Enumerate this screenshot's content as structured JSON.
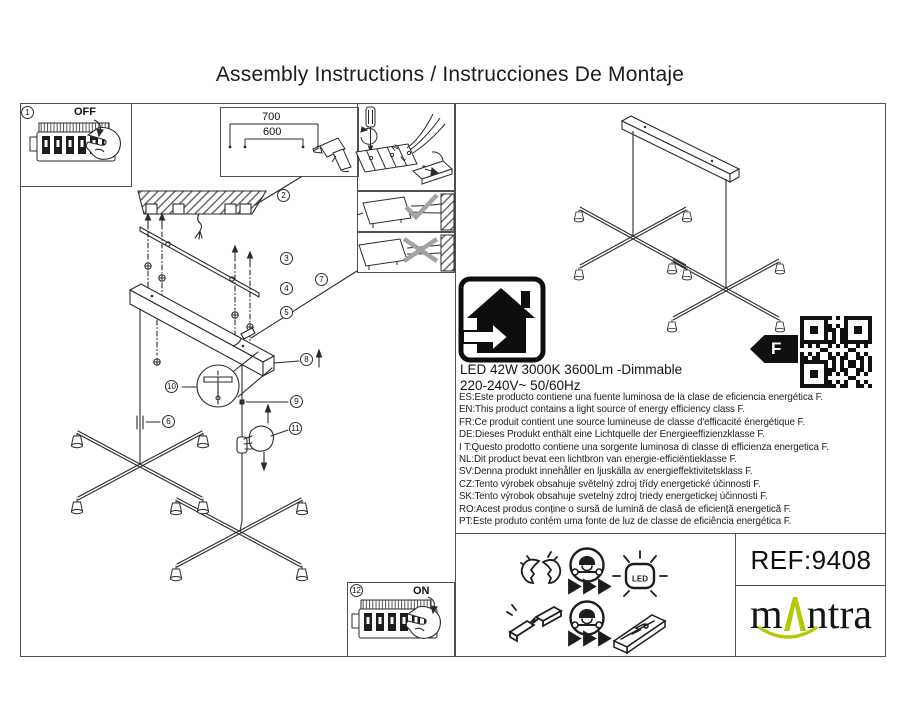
{
  "title": "Assembly Instructions / Instrucciones De Montaje",
  "diagram": {
    "step_numbers": [
      "1",
      "2",
      "3",
      "4",
      "5",
      "6",
      "7",
      "8",
      "9",
      "10",
      "11",
      "12"
    ],
    "off_label": "OFF",
    "on_label": "ON",
    "dim_top": "700",
    "dim_bottom": "600",
    "wire_neutral": "N",
    "wire_live": "L"
  },
  "specs": {
    "line1": "LED 42W 3000K 3600Lm -Dimmable",
    "line2": "220-240V~  50/60Hz"
  },
  "energy": {
    "class_letter": "F",
    "lines": [
      "ES:Este producto contiene una fuente luminosa de la clase de eficiencia energética F.",
      "EN:This product contains a light source of energy efficiency class F.",
      "FR:Ce produit contient une source lumineuse de classe d'efficacité énergétique F.",
      "DE:Dieses Produkt enthält eine Lichtquelle der Energieeffizienzklasse F.",
      "I T:Questo prodotto contiene una sorgente luminosa di classe di efficienza energetica F.",
      "NL:Dit product bevat een lichtbron van energie-efficiëntieklasse F.",
      "SV:Denna produkt innehåller en ljuskälla av energieffektivitetsklass F.",
      "CZ:Tento výrobek obsahuje světelný zdroj třídy energetické účinnosti F.",
      "SK:Tento výrobok obsahuje svetelný zdroj triedy energetickej účinnosti F.",
      "RO:Acest produs conține o sursă de lumină de clasă de eficiență energetică F.",
      "PT:Este produto contém uma fonte de luz de classe de eficiência energética F."
    ]
  },
  "footer": {
    "ref_label": "REF:9408",
    "brand_prefix": "m",
    "brand_suffix": "ntra",
    "brand_color": "#b5c803",
    "led_label": "LED"
  },
  "icons": {
    "house": "indoor-use-house-icon",
    "energy_arrow": "energy-class-arrow-icon",
    "qr": "qr-code",
    "broken_led": "broken-led-icon",
    "technician": "technician-service-icon",
    "led_module": "led-module-icon",
    "broken_driver": "broken-driver-icon",
    "driver": "led-driver-icon",
    "drill": "drill-icon",
    "screwdriver": "screwdriver-icon",
    "breaker": "circuit-breaker-icon",
    "hand": "pointing-hand-icon"
  }
}
